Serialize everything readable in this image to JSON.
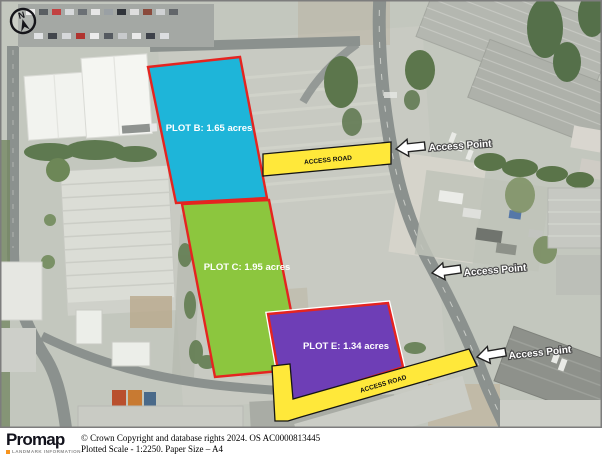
{
  "map": {
    "north_indicator": "N",
    "plots": [
      {
        "name": "Plot B",
        "label": "PLOT B: 1.65 acres",
        "fill": "#1eb5d9"
      },
      {
        "name": "Plot C",
        "label": "PLOT C: 1.95 acres",
        "fill": "#8cc63e"
      },
      {
        "name": "Plot E",
        "label": "PLOT E: 1.34 acres",
        "fill": "#6e3eb6"
      }
    ],
    "access_roads": [
      {
        "label": "ACCESS ROAD"
      },
      {
        "label": "ACCESS ROAD"
      }
    ],
    "access_points": [
      {
        "label": "Access Point"
      },
      {
        "label": "Access Point"
      },
      {
        "label": "Access Point"
      }
    ],
    "colors": {
      "plot_border": "#e52420",
      "plot_label_text": "#ffffff",
      "access_road_fill": "#ffe83a",
      "access_road_border": "#151515",
      "arrow_fill": "#ffffff",
      "arrow_border": "#222222"
    }
  },
  "footer": {
    "brand": "Promap",
    "brand_tagline": "LANDMARK INFORMATION",
    "copyright_line": "© Crown Copyright and database rights 2024. OS AC0000813445",
    "scale_line": "Plotted Scale - 1:2250. Paper Size – A4"
  }
}
